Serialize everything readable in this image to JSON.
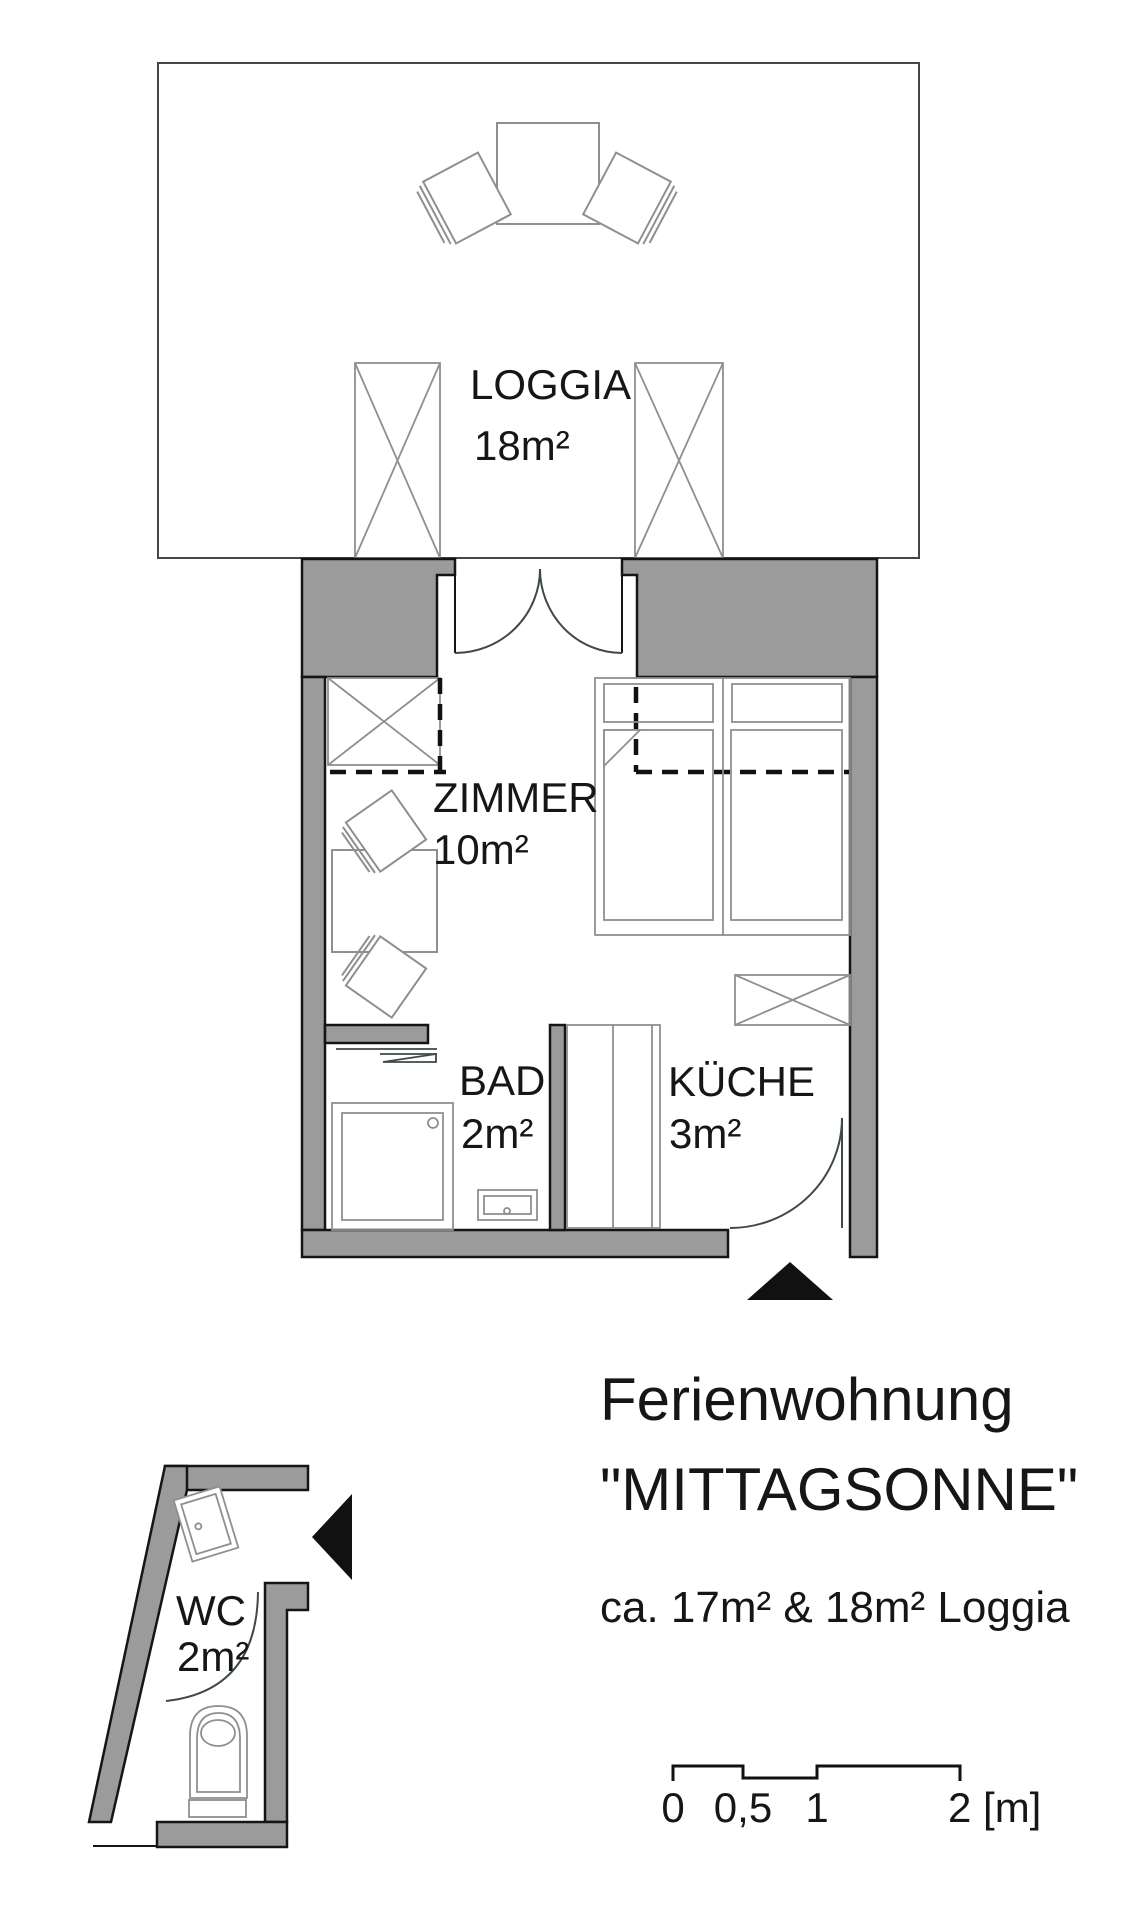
{
  "plan": {
    "rooms": [
      {
        "name": "LOGGIA",
        "area": "18m²"
      },
      {
        "name": "ZIMMER",
        "area": "10m²"
      },
      {
        "name": "BAD",
        "area": "2m²"
      },
      {
        "name": "KÜCHE",
        "area": "3m²"
      },
      {
        "name": "WC",
        "area": "2m²"
      }
    ],
    "title": {
      "line1": "Ferienwohnung",
      "line2": "\"MITTAGSONNE\"",
      "subtitle": "ca. 17m² & 18m² Loggia"
    },
    "scale_bar": {
      "labels": [
        "0",
        "0,5",
        "1",
        "2 [m]"
      ]
    },
    "icons": {
      "entrance_marker": "filled-triangle"
    },
    "colors": {
      "background": "#ffffff",
      "wall_fill": "#9b9b9b",
      "wall_outline": "#151515",
      "architectural_line": "#3e4a42",
      "furniture_line": "#8f8f8f",
      "dashed_line": "#111111",
      "text": "#161616"
    }
  }
}
